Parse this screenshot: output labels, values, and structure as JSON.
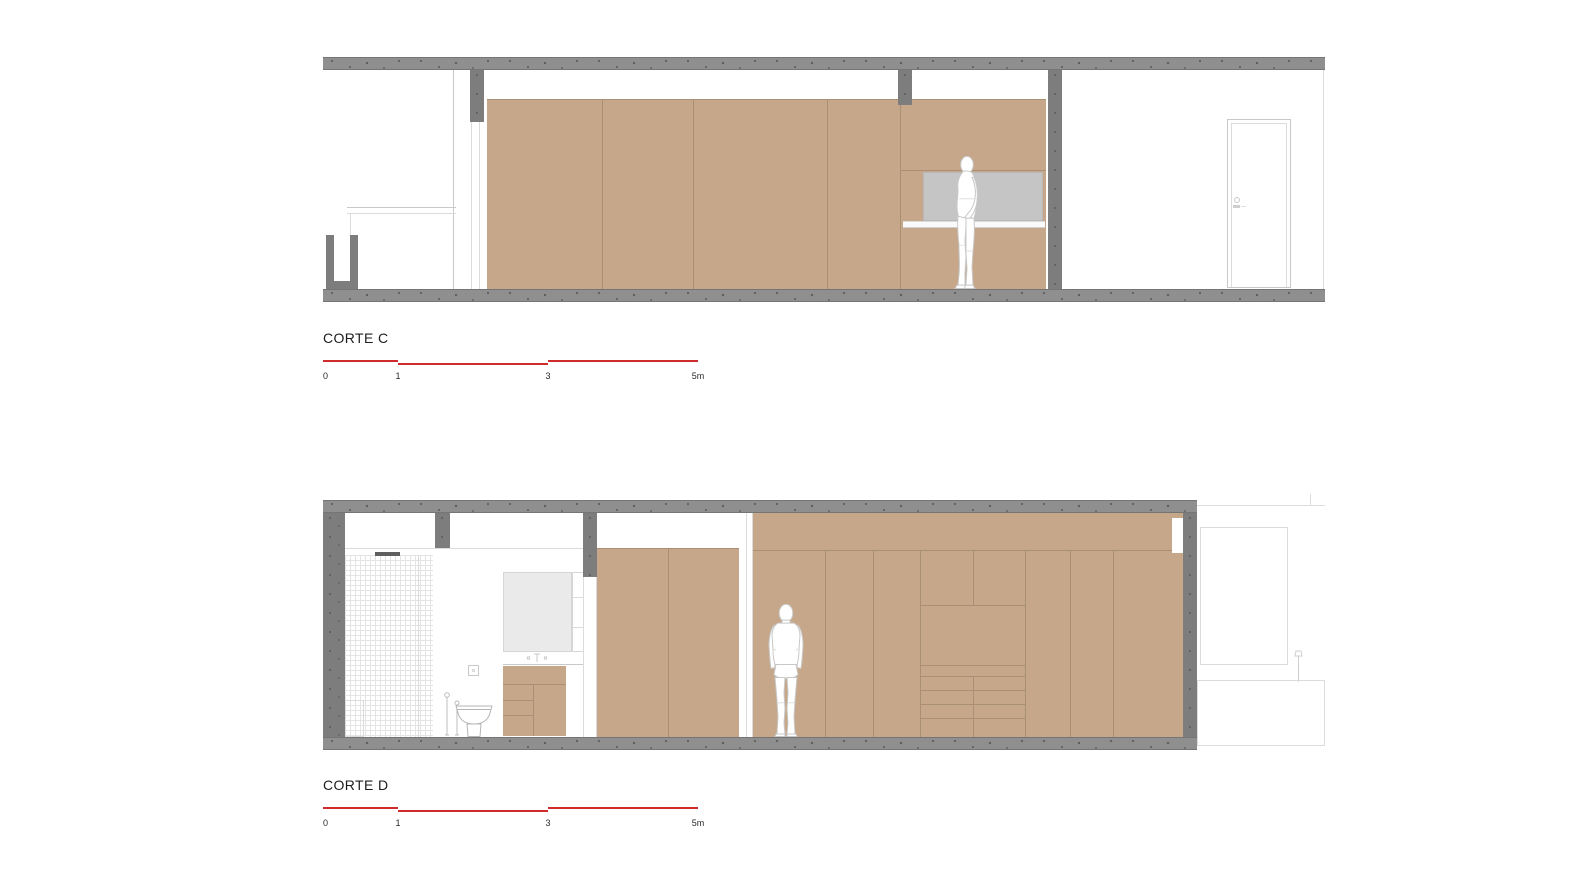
{
  "sections": [
    {
      "id": "corte-c",
      "label": "CORTE C"
    },
    {
      "id": "corte-d",
      "label": "CORTE D"
    }
  ],
  "scale_bar": {
    "unit": "m",
    "length_m": 5,
    "px_per_m": 75,
    "ticks": [
      {
        "label": "0",
        "m": 0
      },
      {
        "label": "1",
        "m": 1
      },
      {
        "label": "3",
        "m": 3
      },
      {
        "label": "5m",
        "m": 5
      }
    ],
    "segments": [
      {
        "from_m": 0,
        "to_m": 1,
        "dy": 0
      },
      {
        "from_m": 1,
        "to_m": 3,
        "dy": 3
      },
      {
        "from_m": 3,
        "to_m": 5,
        "dy": 0
      }
    ]
  },
  "colors": {
    "background": "#ffffff",
    "wood": "#c6a78a",
    "wood_line": "#a98f74",
    "concrete": "#8f8f8f",
    "concrete_dot": "#5e5e5e",
    "concrete_edge": "#757575",
    "wall_gray": "#7d7d7d",
    "panel_gray": "#c5c5c5",
    "mirror_gray": "#eaeaea",
    "drawing_line": "#c9c9c9",
    "faint_line": "#dcdcdc",
    "tile_line": "#e4e4e4",
    "accent_red": "#cf2b2c",
    "text_dark": "#1c1c1c"
  }
}
